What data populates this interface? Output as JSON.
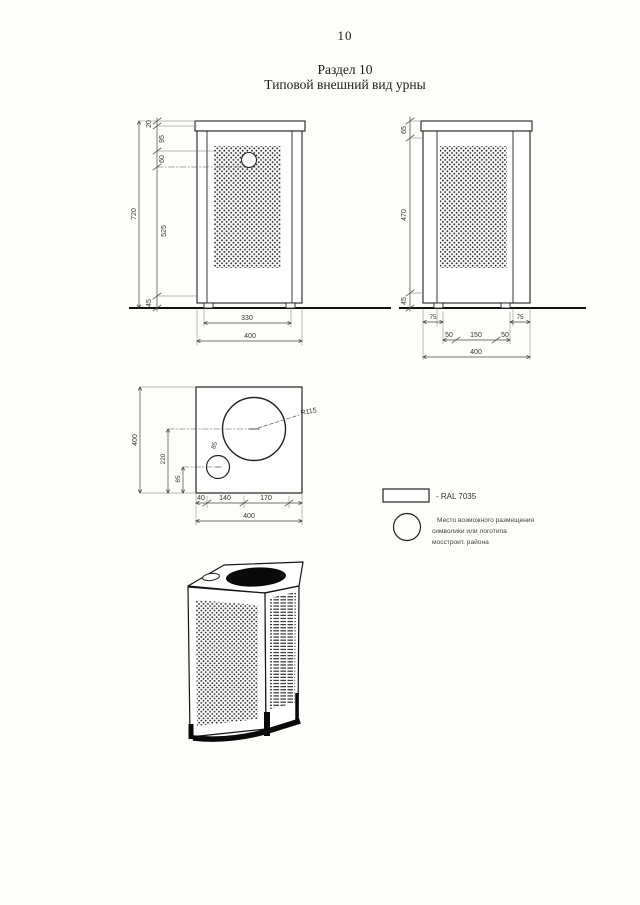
{
  "page": {
    "number": "10",
    "section_heading": "Раздел 10",
    "subtitle": "Типовой внешний вид урны"
  },
  "front_view": {
    "height_chain": [
      "20",
      "95",
      "60",
      "525",
      "45"
    ],
    "total_height": "720",
    "inner_width": "330",
    "total_width": "400"
  },
  "side_view": {
    "left_chain": [
      "65",
      "470",
      "45"
    ],
    "edge_dims": [
      "75",
      "75"
    ],
    "bottom_chain": [
      "50",
      "150",
      "50"
    ],
    "total_depth": "400"
  },
  "plan_view": {
    "outer_dim": "400",
    "center_dims": [
      "220",
      "85"
    ],
    "small_circle_label": "85",
    "big_circle_radius_label": "R115",
    "bottom_chain": [
      "40",
      "140",
      "170"
    ],
    "total_width": "400"
  },
  "legend": {
    "swatch_label": "- RAL 7035",
    "note_lines": [
      "Место возможного размещения",
      "символики или логотипа",
      "мосстроит. района"
    ]
  }
}
